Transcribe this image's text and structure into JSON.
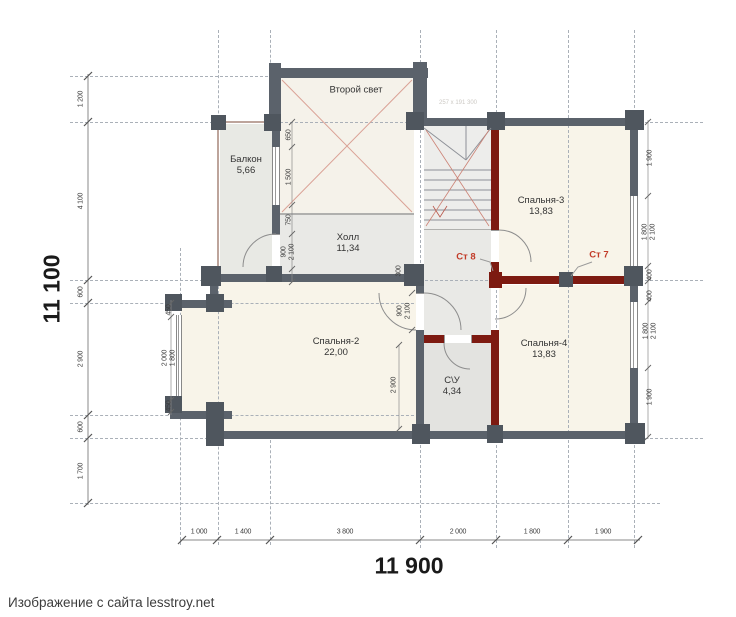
{
  "plan": {
    "rooms": [
      {
        "name": "Балкон",
        "area": "5,66"
      },
      {
        "name": "Второй свет",
        "area": ""
      },
      {
        "name": "Холл",
        "area": "11,34"
      },
      {
        "name": "Спальня-3",
        "area": "13,83"
      },
      {
        "name": "Спальня-2",
        "area": "22,00"
      },
      {
        "name": "Спальня-4",
        "area": "13,83"
      },
      {
        "name": "С\\У",
        "area": "4,34"
      }
    ],
    "wall_tags": [
      {
        "label": "Ст 8"
      },
      {
        "label": "Ст 7"
      }
    ],
    "stair_note": "257 x 191 300",
    "dimensions": {
      "left_total": "11 100",
      "bottom_total": "11 900",
      "left_chain": [
        "1 200",
        "4 100",
        "600",
        "2 900",
        "600",
        "1 700"
      ],
      "bottom_chain": [
        "1 000",
        "1 400",
        "3 800",
        "2 000",
        "1 800",
        "1 900"
      ],
      "right_chain": [
        "1 900",
        "1 800",
        "2 100",
        "400",
        "400",
        "1 800",
        "2 100",
        "1 900"
      ],
      "balcony_chain": [
        "650",
        "1 500",
        "750",
        "900",
        "2 100"
      ],
      "bay_chain": [
        "450",
        "2 000",
        "1 800",
        "450"
      ],
      "inner": {
        "jamb": "300",
        "door_width": "900",
        "door_height": "2 100",
        "su_wall": "2 900"
      }
    },
    "colors": {
      "wall": "#5b626b",
      "red_wall": "#7d1a11",
      "accent_text": "#c23b28",
      "room_cream": "#f8f4e9",
      "room_gray": "#e9e9e6",
      "x_line": "#daa296"
    }
  },
  "caption": "Изображение с сайта lesstroy.net"
}
